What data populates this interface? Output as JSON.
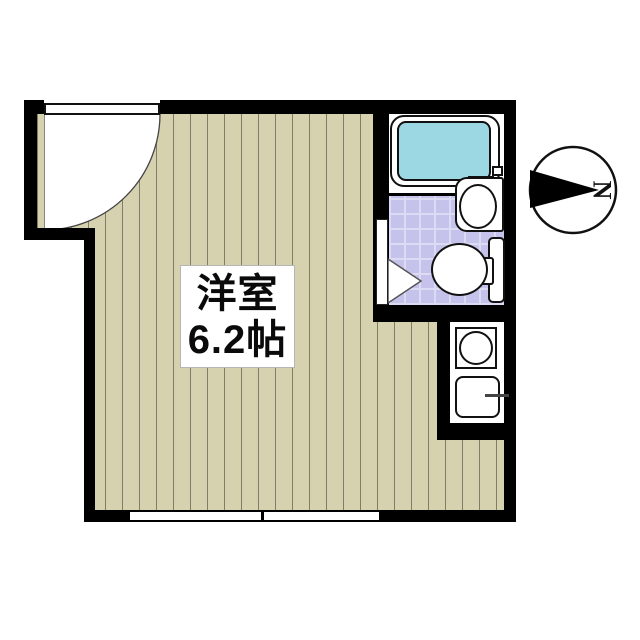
{
  "floorplan": {
    "room": {
      "name": "洋室",
      "size": "6.2帖",
      "floor_type": "wood-strip flooring"
    },
    "compass": {
      "letter": "N",
      "direction": "right"
    },
    "areas": [
      {
        "name": "western-room",
        "label": "洋室 6.2帖"
      },
      {
        "name": "bathroom",
        "label": ""
      },
      {
        "name": "kitchen-nook",
        "label": ""
      }
    ],
    "fixtures": [
      {
        "name": "entrance-door",
        "type": "quarter-swing door, top-left"
      },
      {
        "name": "bathtub",
        "type": "tub with water, top-right"
      },
      {
        "name": "bath-faucet",
        "type": "mixer tap unit"
      },
      {
        "name": "washbasin",
        "type": "oval basin"
      },
      {
        "name": "toilet",
        "type": "bowl with tank"
      },
      {
        "name": "toilet-door",
        "type": "triangle swing marker"
      },
      {
        "name": "gas-burner",
        "type": "single burner"
      },
      {
        "name": "kitchen-sink",
        "type": "sink with faucet"
      },
      {
        "name": "window",
        "type": "double-line sliding window, bottom"
      }
    ],
    "colors": {
      "wall": "#000000",
      "floor": "#d6d2b0",
      "floor_line": "#7f7d68",
      "bath_tile": "#c5c3ec",
      "tile_line": "#dcdbf4",
      "bathtub_water": "#9cd8e4",
      "background": "#ffffff"
    }
  }
}
